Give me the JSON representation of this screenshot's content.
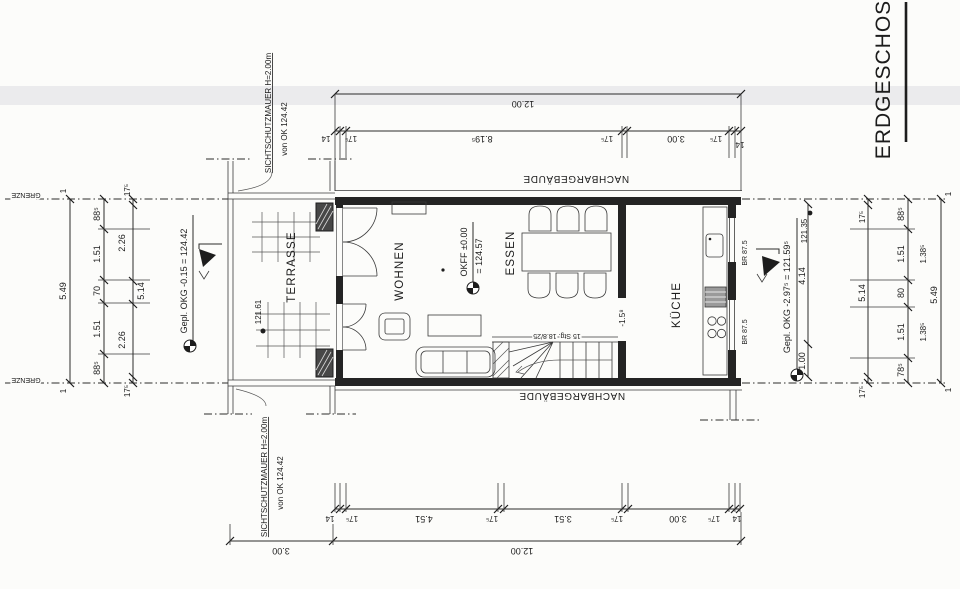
{
  "title": "ERDGESCHOSS",
  "rooms": {
    "living": "WOHNEN",
    "dining": "ESSEN",
    "kitchen": "KÜCHE",
    "terrace": "TERRASSE"
  },
  "context": {
    "neighbor_top": "NACHBARGEBÄUDE",
    "neighbor_bottom": "NACHBARGEBÄUDE",
    "boundary_top": "GRENZE",
    "boundary_bottom": "GRENZE"
  },
  "privacy_wall_top": {
    "name": "SICHTSCHUTZMAUER H=2.00m",
    "level": "von OK 124.42"
  },
  "privacy_wall_bottom": {
    "name": "SICHTSCHUTZMAUER H=2.00m",
    "level": "von OK 124.42"
  },
  "levels": {
    "floor": "OKFF ±0.00",
    "floor_abs": "= 124.57",
    "terrace_spot": "121.61",
    "right_spot": "121.35",
    "terrace_level": "Gepl. OKG -0.15 = 124.42",
    "entry_level": "Gepl. OKG -2.97⁵ = 121.59⁵",
    "stair_landing": "-1.5⁸"
  },
  "stairs": {
    "label": "15 Stg. 18.8/25"
  },
  "windows": {
    "sill_a": "BR 87.5",
    "sill_b": "BR 87.5"
  },
  "dimensions": {
    "top": {
      "total": "12.00",
      "chain": [
        "14",
        "17⁵",
        "8.19⁵",
        "17⁵",
        "3.00",
        "17⁵",
        "14"
      ]
    },
    "bottom": {
      "total": "12.00",
      "terrace": "3.00",
      "chain": [
        "14",
        "17⁵",
        "4.51",
        "17⁵",
        "3.51",
        "17⁵",
        "3.00",
        "17⁵",
        "14"
      ]
    },
    "left": {
      "total": "5.49",
      "end_a": "1",
      "end_b": "1",
      "chain": [
        "88⁵",
        "1.51",
        "70",
        "1.51",
        "88⁵"
      ],
      "inner": [
        "17⁵",
        "2.26",
        "5.14",
        "2.26",
        "17⁵"
      ]
    },
    "right": {
      "total": "5.49",
      "end_a": "1",
      "end_b": "1",
      "chain": [
        "88⁵",
        "1.51",
        "80",
        "1.51",
        "78⁵"
      ],
      "subs": [
        "1.38⁵",
        "1.38⁵"
      ],
      "inner": [
        "17⁵",
        "5.14",
        "17⁵"
      ],
      "depths": [
        "4.14",
        "1.00"
      ]
    }
  }
}
